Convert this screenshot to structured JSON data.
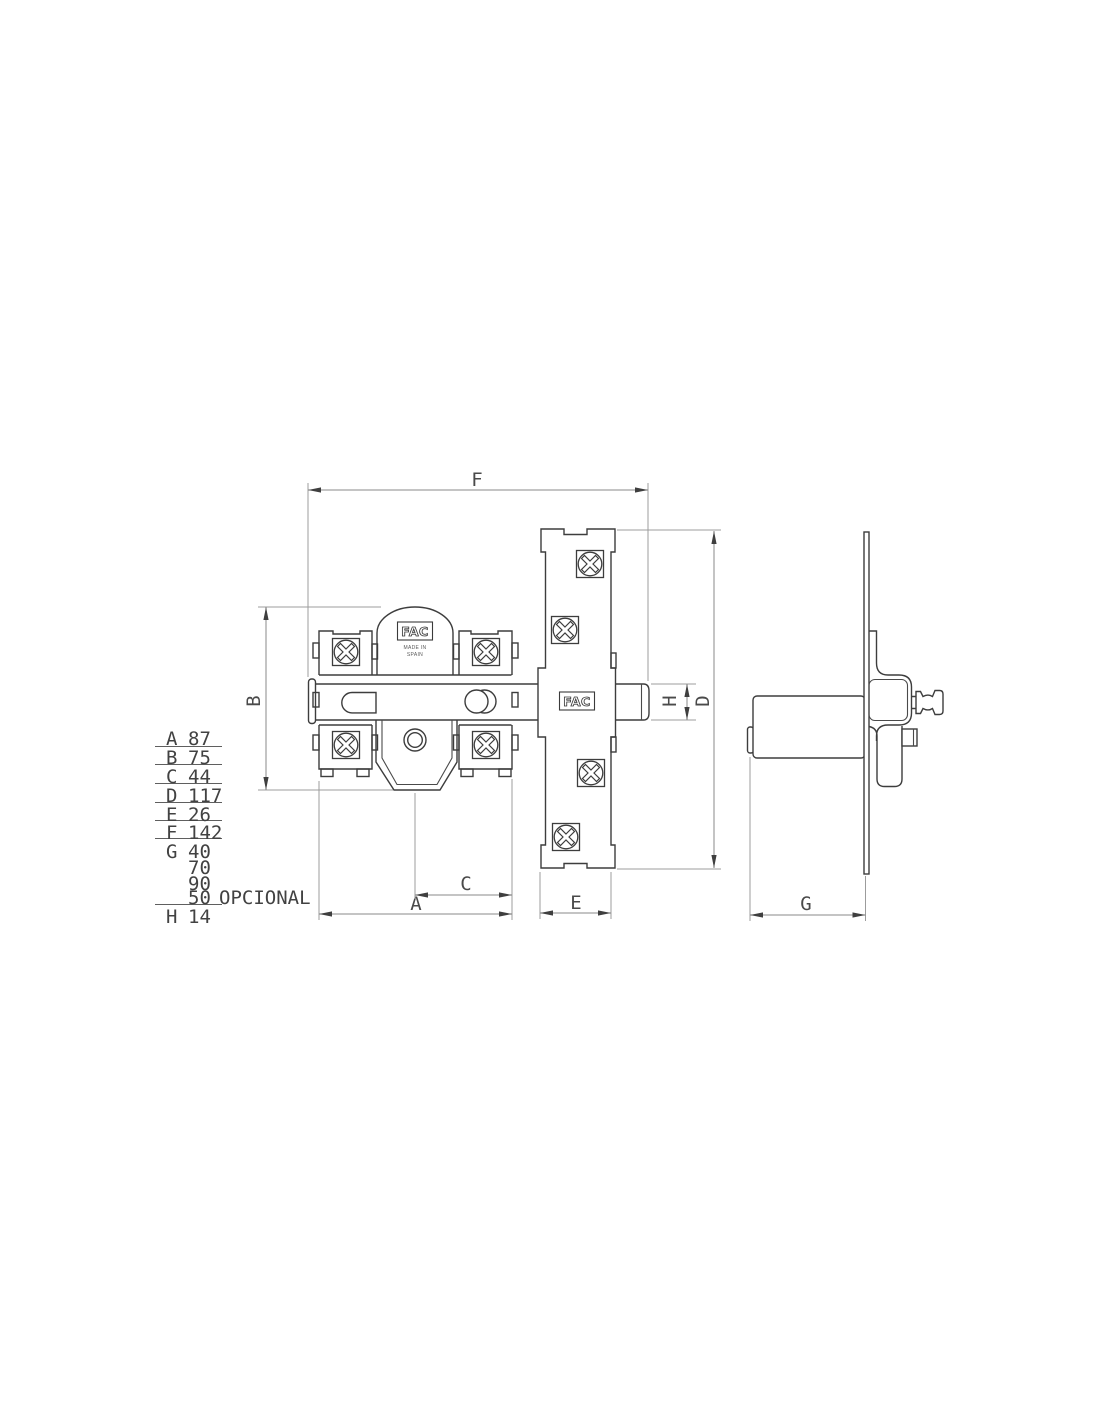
{
  "colors": {
    "outline": "#3d3d3d",
    "dimension_line": "#8a8a8a",
    "ink_text": "#424242"
  },
  "brand": {
    "logo": "FAC",
    "origin_line1": "MADE IN",
    "origin_line2": "SPAIN"
  },
  "dim_labels": {
    "A": "A",
    "B": "B",
    "C": "C",
    "D": "D",
    "E": "E",
    "F": "F",
    "G": "G",
    "H": "H"
  },
  "table": {
    "rows": [
      {
        "key": "A",
        "value": "87",
        "note": ""
      },
      {
        "key": "B",
        "value": "75",
        "note": ""
      },
      {
        "key": "C",
        "value": "44",
        "note": ""
      },
      {
        "key": "D",
        "value": "117",
        "note": ""
      },
      {
        "key": "E",
        "value": "26",
        "note": ""
      },
      {
        "key": "F",
        "value": "142",
        "note": ""
      },
      {
        "key": "G",
        "value": "40",
        "note": ""
      },
      {
        "key": "",
        "value": "70",
        "note": ""
      },
      {
        "key": "",
        "value": "90",
        "note": ""
      },
      {
        "key": "",
        "value": "50",
        "note": "OPCIONAL"
      },
      {
        "key": "H",
        "value": "14",
        "note": ""
      }
    ]
  }
}
